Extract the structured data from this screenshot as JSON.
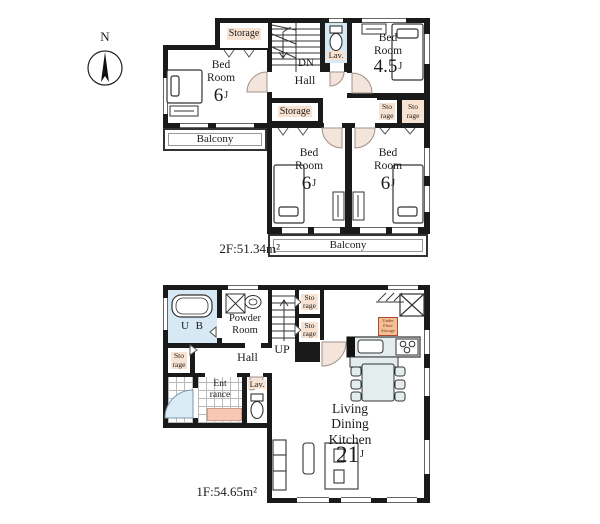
{
  "compass": {
    "north": "N"
  },
  "floor2": {
    "area_label": "2F:51.34m²",
    "rooms": {
      "storage_nw": {
        "label": "Storage"
      },
      "bedroom_nw": {
        "label": "Bed\nRoom",
        "size": "6",
        "size_unit": "J"
      },
      "stairs": {
        "label": "DN"
      },
      "hall": {
        "label": "Hall"
      },
      "lav": {
        "label": "Lav."
      },
      "bedroom_ne": {
        "label": "Bed\nRoom",
        "size": "4.5",
        "size_unit": "J"
      },
      "storage_mid": {
        "label": "Storage"
      },
      "storage_e1": {
        "label": "Sto\nrage"
      },
      "storage_e2": {
        "label": "Sto\nrage"
      },
      "balcony_west": {
        "label": "Balcony"
      },
      "bedroom_sw": {
        "label": "Bed\nRoom",
        "size": "6",
        "size_unit": "J"
      },
      "bedroom_se": {
        "label": "Bed\nRoom",
        "size": "6",
        "size_unit": "J"
      },
      "balcony_south": {
        "label": "Balcony"
      }
    }
  },
  "floor1": {
    "area_label": "1F:54.65m²",
    "rooms": {
      "ub": {
        "label": "U B"
      },
      "powder": {
        "label": "Powder\nRoom"
      },
      "stairs": {
        "label": "UP"
      },
      "storage_n1": {
        "label": "Sto\nrage"
      },
      "storage_n2": {
        "label": "Sto\nrage"
      },
      "storage_w": {
        "label": "Sto\nrage"
      },
      "hall": {
        "label": "Hall"
      },
      "entrance": {
        "label": "Ent\nrance"
      },
      "lav": {
        "label": "Lav."
      },
      "ldk": {
        "label": "Living\nDining\nKitchen",
        "size": "21",
        "size_unit": "J"
      },
      "under_floor_storage": {
        "label": "Under\nFloor\nStorage"
      }
    }
  },
  "colors": {
    "wall": "#1a1a1a",
    "label_bg": "#f8e2d1",
    "door_arc": "#f3e5dc",
    "water_blue": "#d6e9f4",
    "furniture": "#e3edee",
    "entrance_mat": "#f7c9b4",
    "under_floor_storage_bg": "#f0c097"
  }
}
